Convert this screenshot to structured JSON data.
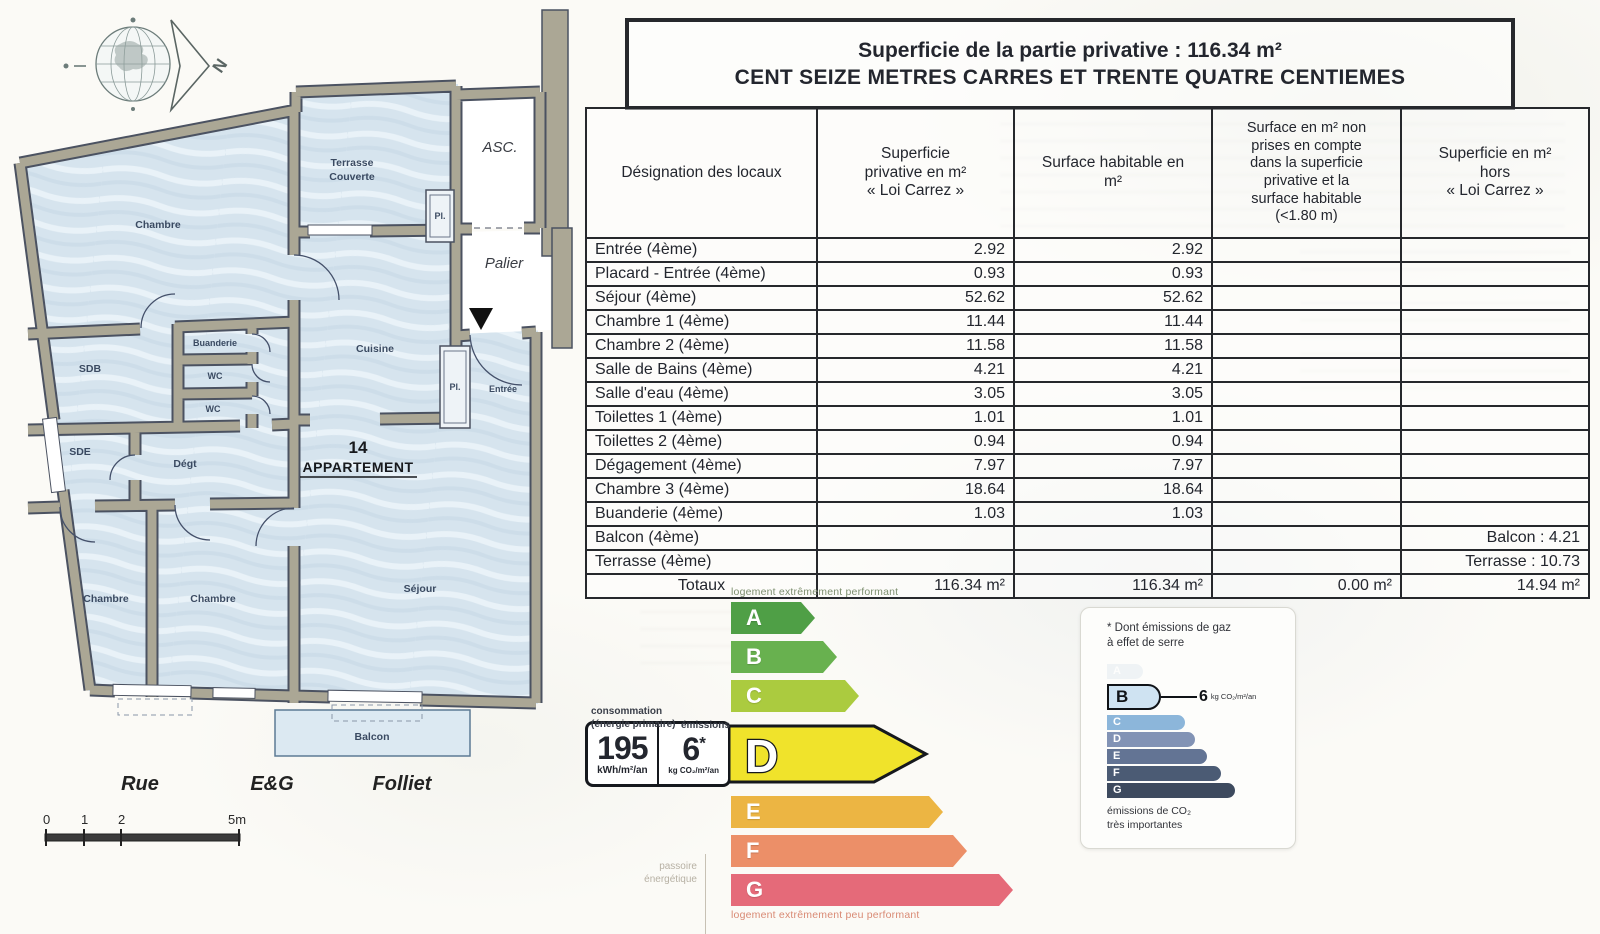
{
  "header": {
    "title_line1": "Superficie de la partie privative : 116.34 m²",
    "title_line2": "CENT SEIZE METRES CARRES ET TRENTE QUATRE CENTIEMES"
  },
  "surface_table": {
    "columns": [
      "Désignation des locaux",
      "Superficie\nprivative en m²\n« Loi Carrez »",
      "Surface habitable en\nm²",
      "Surface en m² non\nprises en compte\ndans la superficie\nprivative et la\nsurface habitable\n(<1.80 m)",
      "Superficie en m²\nhors\n« Loi Carrez »"
    ],
    "rows": [
      {
        "label": "Entrée (4ème)",
        "loi_carrez": "2.92",
        "habitable": "2.92",
        "non_prises": "",
        "hors_carrez": ""
      },
      {
        "label": "Placard - Entrée (4ème)",
        "loi_carrez": "0.93",
        "habitable": "0.93",
        "non_prises": "",
        "hors_carrez": ""
      },
      {
        "label": "Séjour (4ème)",
        "loi_carrez": "52.62",
        "habitable": "52.62",
        "non_prises": "",
        "hors_carrez": ""
      },
      {
        "label": "Chambre 1 (4ème)",
        "loi_carrez": "11.44",
        "habitable": "11.44",
        "non_prises": "",
        "hors_carrez": ""
      },
      {
        "label": "Chambre 2 (4ème)",
        "loi_carrez": "11.58",
        "habitable": "11.58",
        "non_prises": "",
        "hors_carrez": ""
      },
      {
        "label": "Salle de Bains (4ème)",
        "loi_carrez": "4.21",
        "habitable": "4.21",
        "non_prises": "",
        "hors_carrez": ""
      },
      {
        "label": "Salle d'eau (4ème)",
        "loi_carrez": "3.05",
        "habitable": "3.05",
        "non_prises": "",
        "hors_carrez": ""
      },
      {
        "label": "Toilettes 1 (4ème)",
        "loi_carrez": "1.01",
        "habitable": "1.01",
        "non_prises": "",
        "hors_carrez": ""
      },
      {
        "label": "Toilettes 2 (4ème)",
        "loi_carrez": "0.94",
        "habitable": "0.94",
        "non_prises": "",
        "hors_carrez": ""
      },
      {
        "label": "Dégagement (4ème)",
        "loi_carrez": "7.97",
        "habitable": "7.97",
        "non_prises": "",
        "hors_carrez": ""
      },
      {
        "label": "Chambre 3 (4ème)",
        "loi_carrez": "18.64",
        "habitable": "18.64",
        "non_prises": "",
        "hors_carrez": ""
      },
      {
        "label": "Buanderie (4ème)",
        "loi_carrez": "1.03",
        "habitable": "1.03",
        "non_prises": "",
        "hors_carrez": ""
      },
      {
        "label": "Balcon (4ème)",
        "loi_carrez": "",
        "habitable": "",
        "non_prises": "",
        "hors_carrez": "Balcon : 4.21"
      },
      {
        "label": "Terrasse (4ème)",
        "loi_carrez": "",
        "habitable": "",
        "non_prises": "",
        "hors_carrez": "Terrasse : 10.73"
      }
    ],
    "totals": {
      "label": "Totaux",
      "loi_carrez": "116.34 m²",
      "habitable": "116.34 m²",
      "non_prises": "0.00 m²",
      "hors_carrez": "14.94 m²"
    }
  },
  "floor_plan": {
    "north_label": "N",
    "apartment_number": "14",
    "apartment_word": "APPARTEMENT",
    "labels": {
      "chambre_tl": "Chambre",
      "terrasse_1": "Terrasse",
      "terrasse_2": "Couverte",
      "asc": "ASC.",
      "palier": "Palier",
      "pl_top": "Pl.",
      "buanderie": "Buanderie",
      "sdb": "SDB",
      "wc1": "WC",
      "wc2": "WC",
      "cuisine": "Cuisine",
      "pl_entree": "Pl.",
      "entree": "Entrée",
      "sde": "SDE",
      "degt": "Dégt",
      "chambre_bl": "Chambre",
      "chambre_bm": "Chambre",
      "sejour": "Séjour",
      "balcon": "Balcon"
    },
    "street": {
      "word1": "Rue",
      "word2": "E&G",
      "word3": "Folliet"
    },
    "scale_ticks": [
      "0",
      "1",
      "2",
      "5m"
    ]
  },
  "dpe": {
    "top_caption": "logement extrêmement performant",
    "bottom_caption": "logement extrêmement peu performant",
    "left_caption_line1": "consommation",
    "left_caption_line2": "(énergie primaire)",
    "left_caption_emissions": "émissions",
    "passoire_line1": "passoire",
    "passoire_line2": "énergétique",
    "value_consumption": "195",
    "unit_consumption": "kWh/m²/an",
    "value_emissions": "6",
    "emissions_star": "*",
    "unit_emissions": "kg CO₂/m²/an",
    "current_class": "D",
    "classes": [
      {
        "letter": "A",
        "color": "#4f9f46"
      },
      {
        "letter": "B",
        "color": "#68b14f"
      },
      {
        "letter": "C",
        "color": "#abcb3f"
      },
      {
        "letter": "D",
        "color": "#f0e32b"
      },
      {
        "letter": "E",
        "color": "#ecb543"
      },
      {
        "letter": "F",
        "color": "#ec8f68"
      },
      {
        "letter": "G",
        "color": "#e56a79"
      }
    ]
  },
  "ges": {
    "note_line1": "* Dont émissions de gaz",
    "note_line2": "à effet de serre",
    "current_class": "B",
    "value": "6",
    "unit": "kg CO₂/m²/an",
    "bottom_line1": "émissions de CO₂",
    "bottom_line2": "très importantes",
    "classes": [
      {
        "letter": "A",
        "color": "#dfe8ef"
      },
      {
        "letter": "B",
        "color": "#cfe3f2"
      },
      {
        "letter": "C",
        "color": "#8cb6da"
      },
      {
        "letter": "D",
        "color": "#8293b5"
      },
      {
        "letter": "E",
        "color": "#637494"
      },
      {
        "letter": "F",
        "color": "#4b5b74"
      },
      {
        "letter": "G",
        "color": "#3d4a5e"
      }
    ]
  }
}
